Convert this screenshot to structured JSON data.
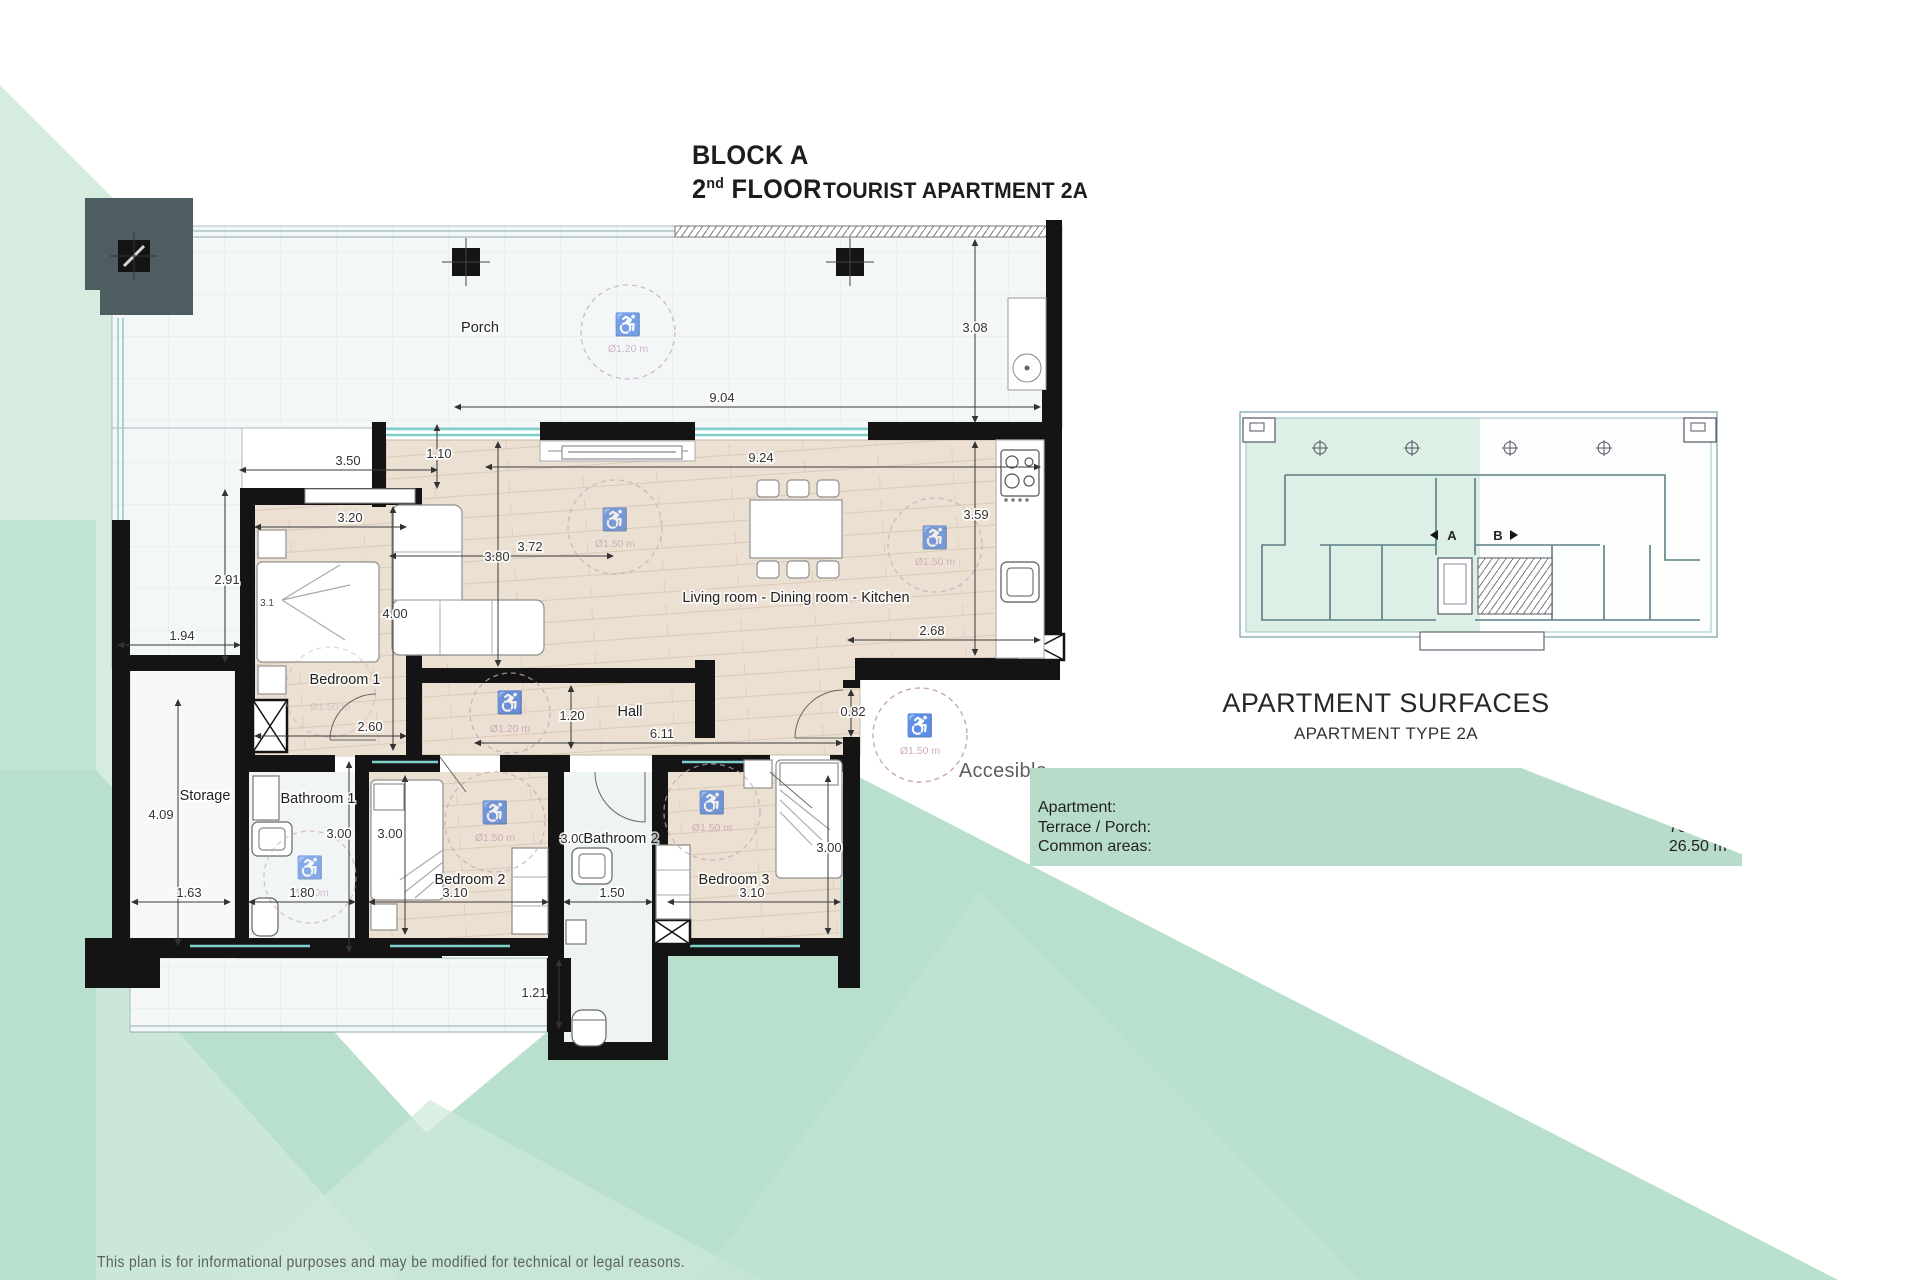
{
  "title": {
    "block": "BLOCK A",
    "floor_num": "2",
    "floor_sup": "nd",
    "floor_word": " FLOOR",
    "apartment": "TOURIST APARTMENT 2A"
  },
  "plan": {
    "rooms": {
      "porch": "Porch",
      "bedroom1": "Bedroom 1",
      "living": "Living room - Dining room - Kitchen",
      "hall": "Hall",
      "storage": "Storage",
      "bathroom1": "Bathroom 1",
      "bathroom2": "Bathroom 2",
      "bedroom2": "Bedroom 2",
      "bedroom3": "Bedroom 3",
      "accessible": "Accesible"
    },
    "dims": {
      "porch_w": "9.04",
      "porch_h": "3.08",
      "offset": "1.10",
      "bed1_w_out": "3.50",
      "bed1_w_in": "3.20",
      "bed1_h_left": "2.91",
      "bed1_h_right": "4.00",
      "bed1_small": "3.1",
      "bed1_w_low": "2.60",
      "terrace_strip": "1.94",
      "living_w": "9.24",
      "living_h": "3.59",
      "living_left_h": "3.80",
      "sofa_w": "3.72",
      "kitchen_w": "2.68",
      "hall_w": "1.20",
      "hall_len": "6.11",
      "exit_door": "0.82",
      "storage_h": "4.09",
      "storage_w": "1.63",
      "bath1_w": "1.80",
      "bath1_h": "3.00",
      "bed2_h": "3.00",
      "bed2_w": "3.10",
      "bath2_h": "3.00",
      "bath2_w": "1.50",
      "bed3_h": "3.00",
      "bed3_w": "3.10",
      "lower_terrace": "1.21"
    },
    "circles": {
      "d120": "Ø1.20 m",
      "d150": "Ø1.50 m",
      "d150_short": "Ø1.50m"
    },
    "icons": {
      "wheelchair": "♿"
    },
    "colors": {
      "mint": "#b9e0cd",
      "mint_light": "#d5ecdf",
      "wood": "#ebe0d2",
      "wall": "#141414",
      "glass": "#7ccfcb",
      "pink": "#c49ab1",
      "slate": "#4e5e60",
      "tile": "#f3f7f7"
    }
  },
  "keyplan": {
    "label_a": "A",
    "label_b": "B"
  },
  "surfaces": {
    "title": "APARTMENT SURFACES",
    "subtitle": "APARTMENT TYPE 2A",
    "rows": [
      {
        "label": "Apartment:",
        "value": "106.20 m²"
      },
      {
        "label": "Terrace / Porch:",
        "value": "70.40 m²"
      },
      {
        "label": "Common areas:",
        "value": "26.50 m²"
      }
    ]
  },
  "disclaimer": "This plan is for informational purposes and may be modified for technical or legal reasons."
}
